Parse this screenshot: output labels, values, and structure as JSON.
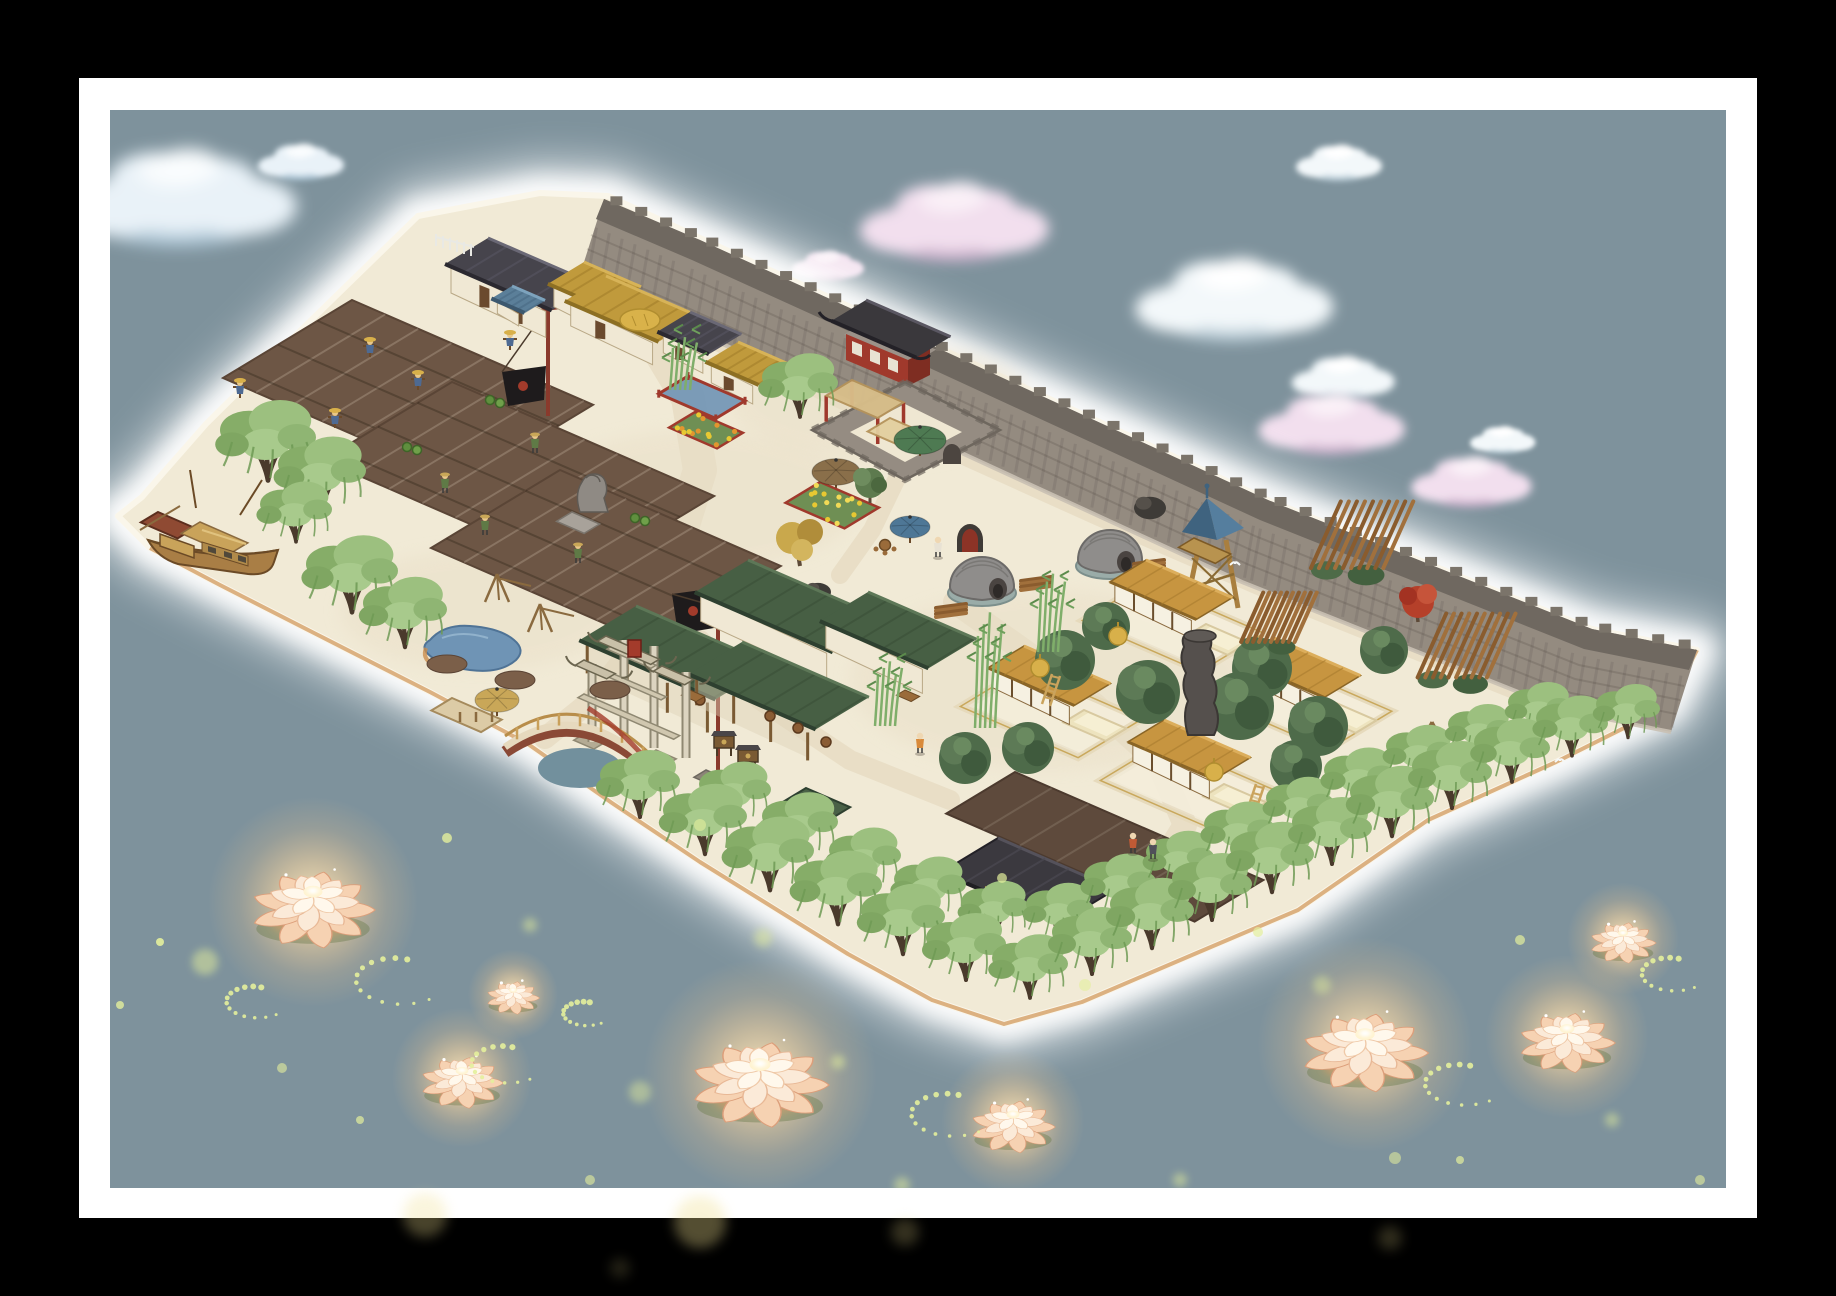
{
  "meta": {
    "app": "jiangnan-village-builder",
    "view": "island-map-screenshot"
  },
  "palette": {
    "black": "#000000",
    "frame_white": "#ffffff",
    "water": "#7E929C",
    "ground": "#F1EAD6",
    "path": "#E8DDC5",
    "field": "#6D5645",
    "field_dark": "#5E4A3C",
    "wall_face": "#948B80",
    "wall_top": "#6F6860",
    "wall_trim": "#C9C0B2",
    "crenel": "#7B746A",
    "roof_tile": "#46444C",
    "thatch": "#C09A3C",
    "roof_green": "#475F44",
    "roof_ochre": "#C79540",
    "red_accent": "#A0392C",
    "willow_leaf": "#9CC07F",
    "pond_blue": "#6F94B5",
    "lotus_glow": "#FFD9A4",
    "firefly": "#E4EF9C",
    "shore_tan": "#CF9454"
  },
  "frame": {
    "outer": [
      79,
      78,
      1678,
      1140
    ],
    "inner": [
      110,
      110,
      1616,
      1078
    ]
  },
  "island": {
    "outline": [
      [
        118,
        516
      ],
      [
        142,
        497
      ],
      [
        206,
        424
      ],
      [
        300,
        331
      ],
      [
        418,
        216
      ],
      [
        470,
        206
      ],
      [
        540,
        193
      ],
      [
        608,
        196
      ],
      [
        700,
        238
      ],
      [
        905,
        332
      ],
      [
        1268,
        500
      ],
      [
        1592,
        629
      ],
      [
        1697,
        650
      ],
      [
        1668,
        706
      ],
      [
        1556,
        762
      ],
      [
        1428,
        820
      ],
      [
        1298,
        910
      ],
      [
        1192,
        955
      ],
      [
        1082,
        1002
      ],
      [
        1004,
        1024
      ],
      [
        932,
        1000
      ],
      [
        848,
        954
      ],
      [
        700,
        862
      ],
      [
        612,
        803
      ],
      [
        528,
        744
      ],
      [
        430,
        692
      ],
      [
        316,
        634
      ],
      [
        220,
        585
      ],
      [
        150,
        548
      ]
    ],
    "shore": [
      [
        1697,
        650
      ],
      [
        1668,
        706
      ],
      [
        1556,
        762
      ],
      [
        1428,
        820
      ],
      [
        1298,
        910
      ],
      [
        1192,
        955
      ],
      [
        1082,
        1002
      ],
      [
        1004,
        1024
      ],
      [
        932,
        1000
      ],
      [
        848,
        954
      ],
      [
        700,
        862
      ],
      [
        612,
        803
      ],
      [
        528,
        744
      ],
      [
        430,
        692
      ],
      [
        316,
        634
      ],
      [
        220,
        585
      ],
      [
        150,
        548
      ]
    ],
    "patches": [
      [
        700,
        500,
        160,
        70
      ],
      [
        1050,
        680,
        200,
        90
      ],
      [
        480,
        610,
        140,
        60
      ],
      [
        880,
        400,
        150,
        60
      ]
    ]
  },
  "wall": {
    "outer": [
      [
        604,
        199
      ],
      [
        700,
        240
      ],
      [
        905,
        333
      ],
      [
        1268,
        500
      ],
      [
        1592,
        629
      ],
      [
        1697,
        650
      ]
    ],
    "gate": {
      "x": 898,
      "y": 330
    },
    "barbican": {
      "cx": 905,
      "cy": 431
    },
    "arch": {
      "x": 957,
      "y": 540
    }
  },
  "clouds": [
    {
      "x": 178,
      "y": 198,
      "s": 1.35,
      "t": "blue"
    },
    {
      "x": 300,
      "y": 162,
      "s": 0.5,
      "t": "blue"
    },
    {
      "x": 952,
      "y": 222,
      "s": 1.1,
      "t": "pink"
    },
    {
      "x": 827,
      "y": 266,
      "s": 0.42,
      "t": "pink"
    },
    {
      "x": 1338,
      "y": 163,
      "s": 0.5,
      "t": "white"
    },
    {
      "x": 1232,
      "y": 300,
      "s": 1.15,
      "t": "white"
    },
    {
      "x": 1342,
      "y": 378,
      "s": 0.6,
      "t": "white"
    },
    {
      "x": 1330,
      "y": 424,
      "s": 0.85,
      "t": "pink"
    },
    {
      "x": 1470,
      "y": 482,
      "s": 0.7,
      "t": "pink"
    },
    {
      "x": 1502,
      "y": 440,
      "s": 0.38,
      "t": "white"
    }
  ],
  "paths": [
    {
      "pts": [
        [
          640,
          318
        ],
        [
          688,
          398
        ],
        [
          700,
          470
        ],
        [
          672,
          560
        ],
        [
          648,
          628
        ]
      ],
      "w": 34
    },
    {
      "pts": [
        [
          686,
          322
        ],
        [
          896,
          420
        ],
        [
          1100,
          512
        ],
        [
          1308,
          602
        ],
        [
          1515,
          685
        ]
      ],
      "w": 28
    },
    {
      "pts": [
        [
          955,
          602
        ],
        [
          1030,
          655
        ],
        [
          1095,
          705
        ],
        [
          1158,
          762
        ],
        [
          1185,
          825
        ],
        [
          1162,
          862
        ]
      ],
      "w": 24
    },
    {
      "pts": [
        [
          648,
          628
        ],
        [
          592,
          700
        ],
        [
          545,
          738
        ]
      ],
      "w": 22
    },
    {
      "pts": [
        [
          700,
          640
        ],
        [
          760,
          700
        ],
        [
          850,
          760
        ],
        [
          950,
          800
        ]
      ],
      "w": 20
    },
    {
      "pts": [
        [
          900,
          472
        ],
        [
          872,
          530
        ],
        [
          840,
          575
        ]
      ],
      "w": 18
    }
  ],
  "fields": [
    [
      352,
      300,
      262,
      150
    ],
    [
      452,
      382,
      285,
      150
    ],
    [
      560,
      470,
      240,
      150
    ]
  ],
  "dark_field": [
    1015,
    772,
    270,
    80
  ],
  "scarecrows": [
    [
      510,
      350
    ],
    [
      418,
      390
    ],
    [
      370,
      357
    ],
    [
      240,
      398
    ],
    [
      335,
      428
    ]
  ],
  "farmers": [
    [
      535,
      448
    ],
    [
      445,
      488
    ],
    [
      578,
      558
    ],
    [
      485,
      530
    ]
  ],
  "buckets": [
    [
      412,
      447
    ],
    [
      495,
      400
    ],
    [
      298,
      455
    ],
    [
      640,
      518
    ]
  ],
  "flagpoles": [
    {
      "x": 548,
      "top": 293,
      "base": 416,
      "bw": 46,
      "bh": 28,
      "by": 372,
      "pedestal": false
    },
    {
      "x": 718,
      "top": 586,
      "base": 778,
      "bw": 46,
      "bh": 34,
      "by": 594,
      "pedestal": true
    }
  ],
  "signboards": [
    [
      724,
      748
    ],
    [
      748,
      762
    ]
  ],
  "houses": [
    {
      "x": 488,
      "y": 238,
      "a": 116,
      "b": 50,
      "h": 26,
      "t": "tile",
      "doors": 2
    },
    {
      "x": 584,
      "y": 262,
      "a": 62,
      "b": 42,
      "h": 20,
      "t": "thatch",
      "doors": 0
    },
    {
      "x": 606,
      "y": 276,
      "a": 102,
      "b": 48,
      "h": 22,
      "t": "thatch",
      "doors": 1,
      "hay": true
    },
    {
      "x": 690,
      "y": 312,
      "a": 56,
      "b": 38,
      "h": 18,
      "t": "tile",
      "doors": 1
    },
    {
      "x": 738,
      "y": 342,
      "a": 58,
      "b": 38,
      "h": 18,
      "t": "thatch",
      "doors": 1
    },
    {
      "x": 512,
      "y": 286,
      "a": 36,
      "b": 24,
      "h": 12,
      "t": "blue",
      "doors": 0
    }
  ],
  "teahouse": [
    {
      "x": 748,
      "y": 560,
      "a": 150,
      "b": 62,
      "h": 26,
      "t": "green",
      "doors": 0
    },
    {
      "x": 868,
      "y": 592,
      "a": 118,
      "b": 56,
      "h": 24,
      "t": "green",
      "doors": 0
    },
    {
      "x": 636,
      "y": 606,
      "a": 148,
      "b": 66,
      "h": 30,
      "t": "green",
      "open": true
    },
    {
      "x": 742,
      "y": 642,
      "a": 138,
      "b": 62,
      "h": 28,
      "t": "green",
      "open": true
    }
  ],
  "teahouse_props": {
    "barrels": [
      [
        770,
        716
      ],
      [
        798,
        728
      ],
      [
        826,
        742
      ],
      [
        700,
        700
      ]
    ],
    "tables": [
      [
        690,
        690
      ],
      [
        905,
        690
      ]
    ]
  },
  "garden": {
    "pergola": {
      "x": 852,
      "y": 380,
      "a": 56,
      "b": 30
    },
    "awning": {
      "x": 890,
      "y": 418,
      "a": 46,
      "b": 26
    },
    "umbrellas": [
      [
        920,
        440,
        26,
        "#4E7A52"
      ],
      [
        836,
        472,
        24,
        "#8A6F4A"
      ],
      [
        910,
        527,
        20,
        "#4E7796"
      ],
      [
        497,
        700,
        22,
        "#C9A758"
      ]
    ],
    "beds": [
      {
        "x": 820,
        "y": 482,
        "a": 64,
        "b": 40,
        "c": [
          "#E8C832",
          "#F2DA56"
        ]
      },
      {
        "x": 695,
        "y": 412,
        "a": 52,
        "b": 30,
        "c": [
          "#E2962F",
          "#E8C832"
        ]
      }
    ],
    "pen": {
      "x": 688,
      "y": 376,
      "a": 62,
      "b": 34
    },
    "rocks": [
      [
        818,
        592,
        13
      ],
      [
        1150,
        508,
        16
      ]
    ],
    "autumn": [
      800,
      548
    ],
    "round_tree": [
      870,
      487
    ],
    "fence": [
      436,
      234
    ],
    "table_set": [
      885,
      545
    ]
  },
  "kilns": [
    [
      982,
      585
    ],
    [
      1110,
      558
    ]
  ],
  "logs": [
    [
      1035,
      585
    ],
    [
      1148,
      568
    ],
    [
      950,
      612
    ]
  ],
  "tower": {
    "x": 1212,
    "peak": 498,
    "base": 608
  },
  "paifang": {
    "x": 633,
    "y": 676
  },
  "lion": {
    "x": 588,
    "y": 500
  },
  "pond": {
    "x": 470,
    "y": 646
  },
  "racks": [
    [
      497,
      588
    ],
    [
      540,
      618
    ]
  ],
  "mounds": [
    [
      447,
      664
    ],
    [
      515,
      680
    ],
    [
      610,
      690
    ]
  ],
  "bridge": {
    "x1": 505,
    "y1": 752,
    "xm": 580,
    "ym": 700,
    "x2": 655,
    "y2": 775
  },
  "dock": [
    452,
    698
  ],
  "boat": {
    "x": 150,
    "y": 500
  },
  "courtyards": [
    [
      1090,
      708
    ],
    [
      1212,
      622
    ],
    [
      1340,
      700
    ],
    [
      1230,
      782
    ]
  ],
  "tree_blobs": [
    [
      1065,
      660,
      30
    ],
    [
      1148,
      692,
      32
    ],
    [
      1262,
      668,
      30
    ],
    [
      1318,
      726,
      30
    ],
    [
      1106,
      626,
      24
    ],
    [
      1028,
      748,
      26
    ],
    [
      1296,
      766,
      26
    ],
    [
      1384,
      650,
      24
    ],
    [
      965,
      758,
      26
    ],
    [
      1240,
      706,
      34
    ]
  ],
  "timbers": [
    [
      1350,
      552,
      1.15
    ],
    [
      1270,
      630,
      0.85
    ],
    [
      1455,
      662,
      1.1
    ]
  ],
  "rock_column": {
    "x": 1198,
    "top": 640,
    "base": 735
  },
  "well": {
    "x": 1432,
    "y": 748
  },
  "maple": [
    1418,
    602
  ],
  "hay_cones": [
    [
      1040,
      668
    ],
    [
      1214,
      772
    ],
    [
      1118,
      636
    ]
  ],
  "ladders": [
    [
      1048,
      690
    ],
    [
      1252,
      800
    ]
  ],
  "dark_building": {
    "x": 998,
    "y": 838,
    "a": 128,
    "b": 66
  },
  "kiosk": {
    "x": 806,
    "y": 788
  },
  "bamboo": [
    [
      985,
      728,
      118
    ],
    [
      885,
      726,
      66
    ],
    [
      1048,
      652,
      80
    ],
    [
      680,
      390,
      54
    ]
  ],
  "willows": {
    "left": [
      [
        268,
        478,
        1.2
      ],
      [
        322,
        508,
        1.1
      ],
      [
        296,
        540,
        0.9
      ],
      [
        352,
        610,
        1.15
      ],
      [
        405,
        645,
        1.05
      ],
      [
        800,
        415,
        0.95
      ]
    ],
    "bottom": [
      [
        735,
        820,
        0.9
      ],
      [
        800,
        854,
        0.95
      ],
      [
        865,
        886,
        0.9
      ],
      [
        930,
        915,
        0.9
      ],
      [
        995,
        936,
        0.85
      ],
      [
        1060,
        938,
        0.85
      ],
      [
        1120,
        912,
        0.9
      ],
      [
        1180,
        886,
        0.85
      ],
      [
        1240,
        860,
        0.9
      ],
      [
        1300,
        832,
        0.85
      ],
      [
        1360,
        806,
        0.9
      ],
      [
        1420,
        780,
        0.85
      ],
      [
        1480,
        756,
        0.8
      ],
      [
        1540,
        734,
        0.8
      ],
      [
        640,
        815,
        1.0
      ],
      [
        705,
        852,
        1.05
      ],
      [
        770,
        888,
        1.1
      ],
      [
        838,
        922,
        1.1
      ],
      [
        903,
        952,
        1.05
      ],
      [
        966,
        978,
        1.0
      ],
      [
        1030,
        996,
        0.95
      ],
      [
        1092,
        972,
        1.0
      ],
      [
        1152,
        946,
        1.05
      ],
      [
        1212,
        918,
        1.0
      ],
      [
        1272,
        890,
        1.05
      ],
      [
        1332,
        862,
        1.0
      ],
      [
        1392,
        834,
        1.05
      ],
      [
        1452,
        806,
        1.0
      ],
      [
        1512,
        780,
        0.95
      ],
      [
        1572,
        754,
        0.9
      ],
      [
        1628,
        736,
        0.8
      ]
    ]
  },
  "people": [
    [
      938,
      552,
      "#E8E2D4"
    ],
    [
      920,
      748,
      "#D98A3A"
    ],
    [
      1133,
      848,
      "#C05A35"
    ],
    [
      1153,
      854,
      "#50505A"
    ]
  ],
  "birds": [
    [
      1235,
      565
    ],
    [
      1560,
      762
    ]
  ],
  "lotuses": [
    {
      "x": 313,
      "y": 910,
      "s": 1.35
    },
    {
      "x": 513,
      "y": 998,
      "s": 0.58
    },
    {
      "x": 462,
      "y": 1083,
      "s": 0.9
    },
    {
      "x": 760,
      "y": 1085,
      "s": 1.5
    },
    {
      "x": 1013,
      "y": 1127,
      "s": 0.92
    },
    {
      "x": 1365,
      "y": 1053,
      "s": 1.38
    },
    {
      "x": 1567,
      "y": 1043,
      "s": 1.05
    },
    {
      "x": 1623,
      "y": 943,
      "s": 0.72
    }
  ],
  "fireflies": {
    "trails": [
      {
        "x": 398,
        "y": 978,
        "r": 50
      },
      {
        "x": 255,
        "y": 1000,
        "r": 34
      },
      {
        "x": 505,
        "y": 1062,
        "r": 40
      },
      {
        "x": 950,
        "y": 1112,
        "r": 46
      },
      {
        "x": 1462,
        "y": 1082,
        "r": 44
      },
      {
        "x": 1672,
        "y": 972,
        "r": 36
      },
      {
        "x": 585,
        "y": 1012,
        "r": 26
      }
    ],
    "dots": [
      [
        205,
        962,
        13,
        0.5
      ],
      [
        160,
        942,
        4,
        0.9
      ],
      [
        447,
        838,
        5,
        0.8
      ],
      [
        530,
        925,
        7,
        0.5
      ],
      [
        120,
        1005,
        4,
        0.8
      ],
      [
        640,
        1092,
        11,
        0.45
      ],
      [
        700,
        825,
        6,
        0.6
      ],
      [
        763,
        938,
        9,
        0.5
      ],
      [
        838,
        1062,
        7,
        0.55
      ],
      [
        902,
        1185,
        8,
        0.5
      ],
      [
        1002,
        878,
        5,
        0.7
      ],
      [
        1085,
        985,
        6,
        0.6
      ],
      [
        1180,
        1180,
        7,
        0.5
      ],
      [
        1258,
        932,
        5,
        0.7
      ],
      [
        1322,
        985,
        9,
        0.45
      ],
      [
        1395,
        1158,
        6,
        0.55
      ],
      [
        1520,
        940,
        5,
        0.7
      ],
      [
        1612,
        1120,
        7,
        0.5
      ],
      [
        1700,
        1180,
        5,
        0.6
      ],
      [
        1745,
        905,
        4,
        0.7
      ],
      [
        590,
        1180,
        5,
        0.6
      ],
      [
        360,
        1120,
        4,
        0.7
      ],
      [
        282,
        1068,
        5,
        0.6
      ],
      [
        1460,
        1160,
        4,
        0.7
      ]
    ],
    "bleed": [
      [
        425,
        1215,
        22,
        0.3
      ],
      [
        700,
        1222,
        26,
        0.35
      ],
      [
        905,
        1232,
        14,
        0.22
      ],
      [
        1390,
        1238,
        12,
        0.2
      ],
      [
        620,
        1268,
        10,
        0.15
      ]
    ]
  }
}
